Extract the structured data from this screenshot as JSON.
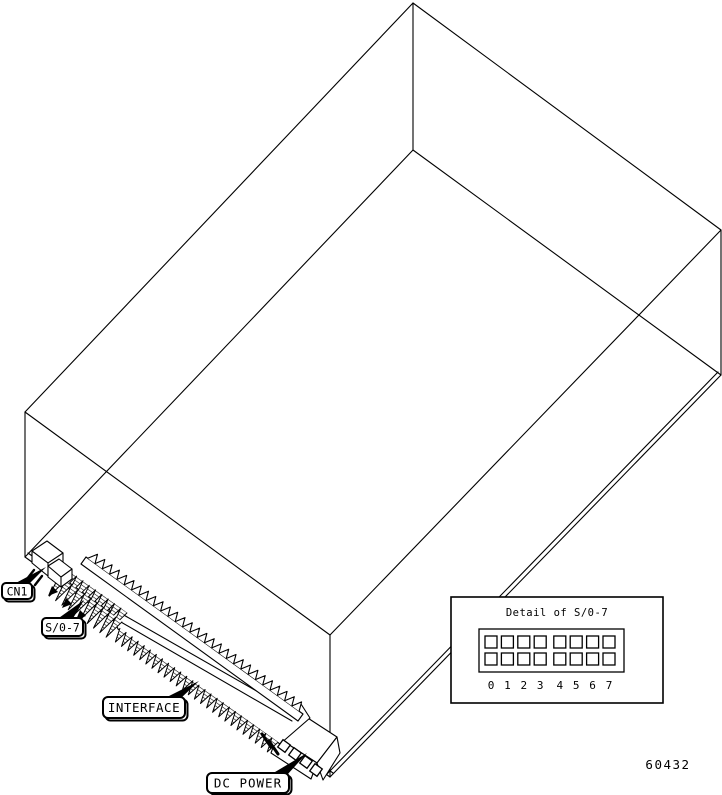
{
  "figure": {
    "number": "60432",
    "background": "#ffffff",
    "line_color": "#000000"
  },
  "callouts": {
    "cn1": {
      "label": "CN1"
    },
    "s07": {
      "label": "S/0-7"
    },
    "interface": {
      "label": "INTERFACE"
    },
    "dc_power": {
      "label": "DC POWER"
    }
  },
  "detail_box": {
    "title": "Detail of S/0-7",
    "rows": 2,
    "positions": [
      "0",
      "1",
      "2",
      "3",
      "4",
      "5",
      "6",
      "7"
    ]
  }
}
